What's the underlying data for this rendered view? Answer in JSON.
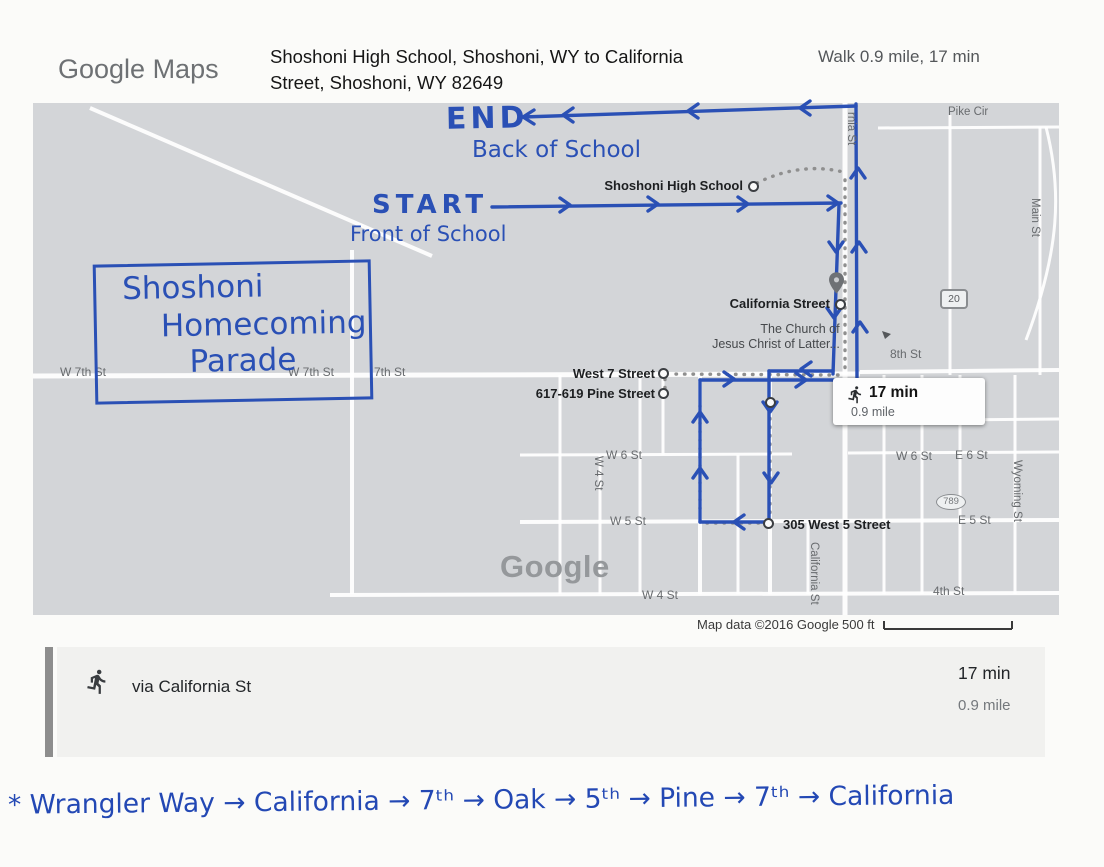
{
  "header": {
    "logo": "Google Maps",
    "title_line1": "Shoshoni High School, Shoshoni, WY to California",
    "title_line2": "Street, Shoshoni, WY 82649",
    "summary": "Walk 0.9 mile, 17 min"
  },
  "map": {
    "watermark": "Google",
    "attribution": "Map data ©2016 Google",
    "scale_label": "500 ft",
    "pois": {
      "high_school": "Shoshoni High School",
      "california_street": "California Street",
      "church_line1": "The Church of",
      "church_line2": "Jesus Christ of Latter...",
      "west_7_street": "West 7 Street",
      "pine_street": "617-619 Pine Street",
      "west_5_street": "305 West 5 Street"
    },
    "streets": {
      "w7th_left": "W 7th St",
      "w7th_mid": "W 7th St",
      "seventh": "7th St",
      "eighth": "8th St",
      "w6_left": "W 6 St",
      "w6_right": "W 6 St",
      "e6": "E 6 St",
      "w5": "W 5 St",
      "e5": "E 5 St",
      "w4_bottom": "W 4 St",
      "fourth": "4th St",
      "pike_cir": "Pike Cir",
      "california_top": "rnia St",
      "main": "Main St",
      "wyoming": "Wyoming St",
      "california_bottom": "California St",
      "w4_vertical": "W 4 St"
    },
    "shields": {
      "us20": "20",
      "wy789": "789"
    },
    "badge": {
      "duration": "17 min",
      "distance": "0.9 mile"
    }
  },
  "annotations": {
    "end_label": "END",
    "end_sub": "Back of School",
    "start_label": "START",
    "start_sub": "Front of School",
    "box_line1": "Shoshoni",
    "box_line2": "Homecoming",
    "box_line3": "Parade",
    "route_note": "* Wrangler Way → California → 7ᵗʰ → Oak → 5ᵗʰ → Pine → 7ᵗʰ → California"
  },
  "panel": {
    "via": "via California St",
    "duration": "17 min",
    "distance": "0.9 mile"
  },
  "colors": {
    "ink_blue": "#2a50b5",
    "map_gray": "#d3d5d8",
    "panel_gray": "#f1f1ef",
    "accent_bar_gray": "#8d8d8d",
    "dotted_route_gray": "#8f8f8f",
    "road_white": "#ffffff"
  }
}
